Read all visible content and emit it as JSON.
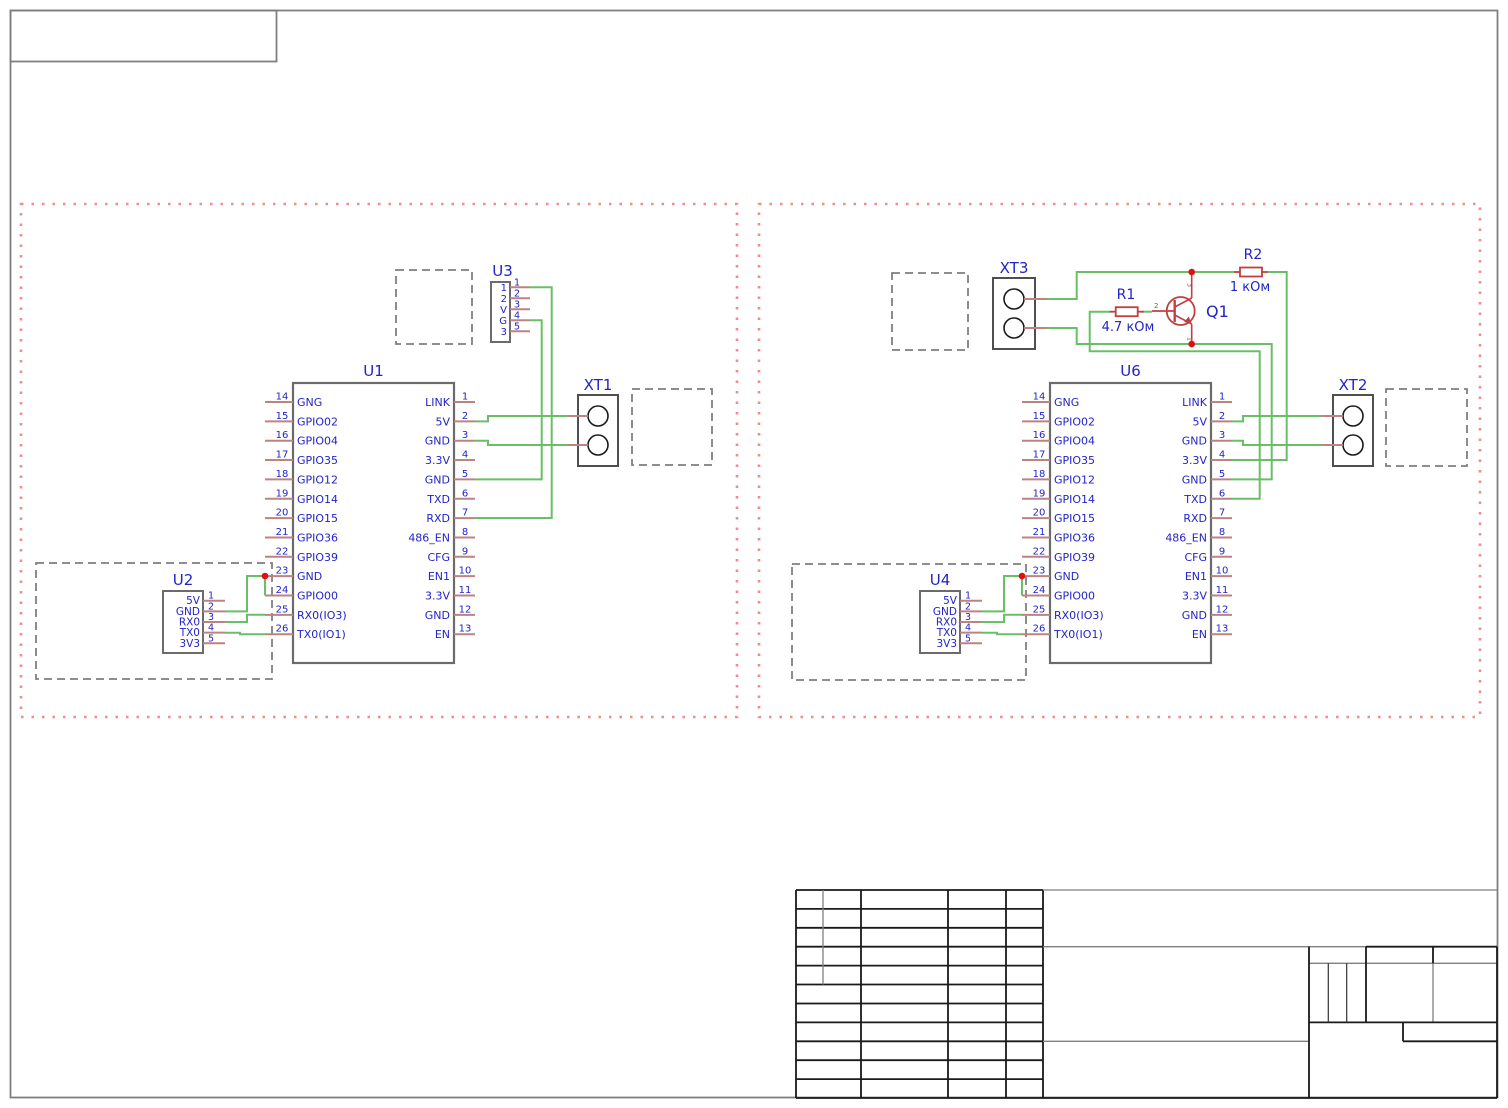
{
  "colors": {
    "wire": "#69bf67",
    "pin": "#bc8383",
    "label": "#2323c8",
    "device": "#c04040",
    "junction": "#e01010",
    "dashed": "#7f7f7f",
    "ic_border": "#6b6b6b",
    "terminal_border": "#4f4f4f",
    "module_border": "#f28b8b",
    "frame_gray": "#7f7f7f",
    "table_black": "#1a1a1a"
  },
  "modules": [
    {
      "name": "module-left",
      "frame": {
        "x": 21,
        "y": 204,
        "w": 716,
        "h": 513
      },
      "dashed_boxes": [
        {
          "x": 396,
          "y": 270,
          "w": 76,
          "h": 74
        },
        {
          "x": 632,
          "y": 389,
          "w": 80,
          "h": 76
        },
        {
          "x": 36,
          "y": 563,
          "w": 236,
          "h": 116
        }
      ],
      "ics": [
        {
          "ref": "U1",
          "x": 293,
          "y": 383,
          "w": 161,
          "h": 280,
          "pin_y0": 402,
          "pin_dy": 19.35,
          "left_pins": [
            {
              "num": "14",
              "name": "GNG"
            },
            {
              "num": "15",
              "name": "GPIO02"
            },
            {
              "num": "16",
              "name": "GPIO04"
            },
            {
              "num": "17",
              "name": "GPIO35"
            },
            {
              "num": "18",
              "name": "GPIO12"
            },
            {
              "num": "19",
              "name": "GPIO14"
            },
            {
              "num": "20",
              "name": "GPIO15"
            },
            {
              "num": "21",
              "name": "GPIO36"
            },
            {
              "num": "22",
              "name": "GPIO39"
            },
            {
              "num": "23",
              "name": "GND"
            },
            {
              "num": "24",
              "name": "GPIO00"
            },
            {
              "num": "25",
              "name": "RX0(IO3)"
            },
            {
              "num": "26",
              "name": "TX0(IO1)"
            }
          ],
          "right_pins": [
            {
              "num": "1",
              "name": "LINK"
            },
            {
              "num": "2",
              "name": "5V"
            },
            {
              "num": "3",
              "name": "GND"
            },
            {
              "num": "4",
              "name": "3.3V"
            },
            {
              "num": "5",
              "name": "GND"
            },
            {
              "num": "6",
              "name": "TXD"
            },
            {
              "num": "7",
              "name": "RXD"
            },
            {
              "num": "8",
              "name": "486_EN"
            },
            {
              "num": "9",
              "name": "CFG"
            },
            {
              "num": "10",
              "name": "EN1"
            },
            {
              "num": "11",
              "name": "3.3V"
            },
            {
              "num": "12",
              "name": "GND"
            },
            {
              "num": "13",
              "name": "EN"
            }
          ]
        }
      ],
      "small_ics": [
        {
          "ref": "U2",
          "x": 163,
          "y": 591,
          "w": 40,
          "h": 62,
          "pin_y0": 600.7,
          "pin_dy": 10.65,
          "pins": [
            {
              "num": "1",
              "name": "5V"
            },
            {
              "num": "2",
              "name": "GND"
            },
            {
              "num": "3",
              "name": "RX0"
            },
            {
              "num": "4",
              "name": "TX0"
            },
            {
              "num": "5",
              "name": "3V3"
            }
          ]
        }
      ],
      "pin_headers": [
        {
          "ref": "U3",
          "x": 491,
          "y": 282,
          "w": 19,
          "h": 60,
          "pin_y0": 287.3,
          "pin_dy": 11,
          "pins": [
            {
              "num": "1",
              "name": "1"
            },
            {
              "num": "2",
              "name": "2"
            },
            {
              "num": "3",
              "name": "V"
            },
            {
              "num": "4",
              "name": "G"
            },
            {
              "num": "5",
              "name": "3"
            }
          ]
        }
      ],
      "terminals": [
        {
          "ref": "XT1",
          "x": 578,
          "y": 395,
          "w": 40,
          "h": 71,
          "side": "left"
        }
      ],
      "resistors": [],
      "transistors": [],
      "junctions": [
        [
          265,
          576
        ]
      ],
      "wires": [
        [
          [
            530,
            287.3
          ],
          [
            551.7,
            287.3
          ],
          [
            551.7,
            518
          ],
          [
            475,
            518
          ]
        ],
        [
          [
            530,
            320.3
          ],
          [
            541.7,
            320.3
          ],
          [
            541.7,
            479.4
          ],
          [
            475,
            479.4
          ]
        ],
        [
          [
            475,
            421.4
          ],
          [
            488,
            421.4
          ],
          [
            488,
            416
          ],
          [
            567,
            416
          ]
        ],
        [
          [
            475,
            440.7
          ],
          [
            488,
            440.7
          ],
          [
            488,
            445
          ],
          [
            567,
            445
          ]
        ],
        [
          [
            225,
            611.4
          ],
          [
            247,
            611.4
          ],
          [
            247,
            576
          ],
          [
            265,
            576
          ]
        ],
        [
          [
            265,
            576
          ],
          [
            265,
            595.4
          ]
        ],
        [
          [
            225,
            622
          ],
          [
            247,
            622
          ],
          [
            247,
            614.7
          ],
          [
            265,
            614.7
          ]
        ],
        [
          [
            225,
            632.7
          ],
          [
            240,
            632.7
          ],
          [
            240,
            634.2
          ],
          [
            265,
            634.2
          ]
        ]
      ]
    },
    {
      "name": "module-right",
      "frame": {
        "x": 759,
        "y": 204,
        "w": 721,
        "h": 513
      },
      "dashed_boxes": [
        {
          "x": 892,
          "y": 273,
          "w": 76,
          "h": 77
        },
        {
          "x": 1386,
          "y": 389,
          "w": 81,
          "h": 77
        },
        {
          "x": 792,
          "y": 564,
          "w": 234,
          "h": 116
        }
      ],
      "ics": [
        {
          "ref": "U6",
          "x": 1050,
          "y": 383,
          "w": 161,
          "h": 280,
          "pin_y0": 402,
          "pin_dy": 19.35,
          "left_pins": [
            {
              "num": "14",
              "name": "GNG"
            },
            {
              "num": "15",
              "name": "GPIO02"
            },
            {
              "num": "16",
              "name": "GPIO04"
            },
            {
              "num": "17",
              "name": "GPIO35"
            },
            {
              "num": "18",
              "name": "GPIO12"
            },
            {
              "num": "19",
              "name": "GPIO14"
            },
            {
              "num": "20",
              "name": "GPIO15"
            },
            {
              "num": "21",
              "name": "GPIO36"
            },
            {
              "num": "22",
              "name": "GPIO39"
            },
            {
              "num": "23",
              "name": "GND"
            },
            {
              "num": "24",
              "name": "GPIO00"
            },
            {
              "num": "25",
              "name": "RX0(IO3)"
            },
            {
              "num": "26",
              "name": "TX0(IO1)"
            }
          ],
          "right_pins": [
            {
              "num": "1",
              "name": "LINK"
            },
            {
              "num": "2",
              "name": "5V"
            },
            {
              "num": "3",
              "name": "GND"
            },
            {
              "num": "4",
              "name": "3.3V"
            },
            {
              "num": "5",
              "name": "GND"
            },
            {
              "num": "6",
              "name": "TXD"
            },
            {
              "num": "7",
              "name": "RXD"
            },
            {
              "num": "8",
              "name": "486_EN"
            },
            {
              "num": "9",
              "name": "CFG"
            },
            {
              "num": "10",
              "name": "EN1"
            },
            {
              "num": "11",
              "name": "3.3V"
            },
            {
              "num": "12",
              "name": "GND"
            },
            {
              "num": "13",
              "name": "EN"
            }
          ]
        }
      ],
      "small_ics": [
        {
          "ref": "U4",
          "x": 920,
          "y": 591,
          "w": 40,
          "h": 62,
          "pin_y0": 600.7,
          "pin_dy": 10.65,
          "pins": [
            {
              "num": "1",
              "name": "5V"
            },
            {
              "num": "2",
              "name": "GND"
            },
            {
              "num": "3",
              "name": "RX0"
            },
            {
              "num": "4",
              "name": "TX0"
            },
            {
              "num": "5",
              "name": "3V3"
            }
          ]
        }
      ],
      "pin_headers": [],
      "terminals": [
        {
          "ref": "XT3",
          "x": 993,
          "y": 278,
          "w": 42,
          "h": 71,
          "side": "right"
        },
        {
          "ref": "XT2",
          "x": 1333,
          "y": 395,
          "w": 40,
          "h": 71,
          "side": "left"
        }
      ],
      "resistors": [
        {
          "ref": "R1",
          "value": "4.7 кОм",
          "cx": 1126.7,
          "cy": 311.7,
          "ref_x": 1126,
          "ref_y": 299,
          "val_x": 1128,
          "val_y": 331
        },
        {
          "ref": "R2",
          "value": "1 кОм",
          "cx": 1251,
          "cy": 272,
          "ref_x": 1253,
          "ref_y": 259,
          "val_x": 1250,
          "val_y": 291
        }
      ],
      "transistors": [
        {
          "ref": "Q1",
          "cx": 1180.7,
          "cy": 311,
          "r": 14,
          "collector_y": 272,
          "emitter_y": 344,
          "base_x": 1152,
          "pins": {
            "base": "2",
            "collector": "3",
            "emitter": "1"
          },
          "ref_x": 1206,
          "ref_y": 317
        }
      ],
      "junctions": [
        [
          1022,
          576
        ],
        [
          1191.7,
          272
        ],
        [
          1191.7,
          344
        ]
      ],
      "wires": [
        [
          [
            1047,
            299
          ],
          [
            1076.7,
            299
          ],
          [
            1076.7,
            272
          ],
          [
            1191.7,
            272
          ]
        ],
        [
          [
            1191.7,
            272
          ],
          [
            1234,
            272
          ]
        ],
        [
          [
            1268,
            272
          ],
          [
            1286.7,
            272
          ],
          [
            1286.7,
            460
          ],
          [
            1232,
            460
          ]
        ],
        [
          [
            1047,
            328
          ],
          [
            1076.7,
            328
          ],
          [
            1076.7,
            344
          ],
          [
            1191.7,
            344
          ]
        ],
        [
          [
            1191.7,
            344
          ],
          [
            1271.7,
            344
          ],
          [
            1271.7,
            479.4
          ],
          [
            1232,
            479.4
          ]
        ],
        [
          [
            1110.7,
            311.7
          ],
          [
            1089.7,
            311.7
          ],
          [
            1089.7,
            351.3
          ],
          [
            1259.7,
            351.3
          ],
          [
            1259.7,
            498.7
          ],
          [
            1232,
            498.7
          ]
        ],
        [
          [
            1142.7,
            311.7
          ],
          [
            1152,
            311.7
          ]
        ],
        [
          [
            1232,
            421.4
          ],
          [
            1243,
            421.4
          ],
          [
            1243,
            416
          ],
          [
            1322,
            416
          ]
        ],
        [
          [
            1232,
            440.7
          ],
          [
            1243,
            440.7
          ],
          [
            1243,
            445
          ],
          [
            1322,
            445
          ]
        ],
        [
          [
            982,
            611.4
          ],
          [
            1004,
            611.4
          ],
          [
            1004,
            576
          ],
          [
            1022,
            576
          ]
        ],
        [
          [
            1022,
            576
          ],
          [
            1022,
            595.4
          ]
        ],
        [
          [
            982,
            622
          ],
          [
            1004,
            622
          ],
          [
            1004,
            614.7
          ],
          [
            1022,
            614.7
          ]
        ],
        [
          [
            982,
            632.7
          ],
          [
            997,
            632.7
          ],
          [
            997,
            634.2
          ],
          [
            1022,
            634.2
          ]
        ]
      ]
    }
  ]
}
